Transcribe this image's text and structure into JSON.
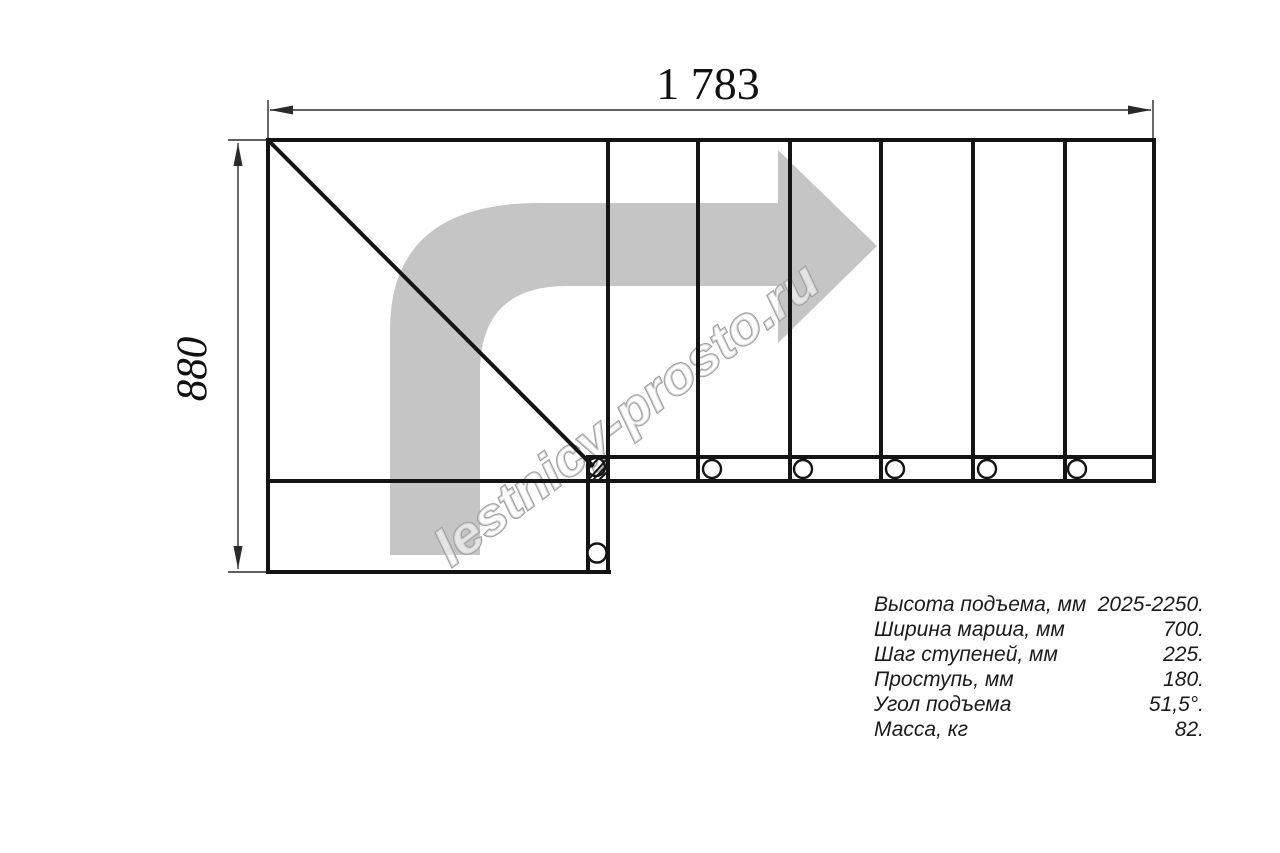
{
  "dimensions": {
    "width_label": "1 783",
    "height_label": "880"
  },
  "watermark": {
    "text": "lestnicy-prosto.ru"
  },
  "specs": {
    "rows": [
      {
        "label": "Высота подъема, мм",
        "value": "2025-2250."
      },
      {
        "label": "Ширина марша, мм",
        "value": "700."
      },
      {
        "label": "Шаг ступеней, мм",
        "value": "225."
      },
      {
        "label": "Проступь, мм",
        "value": "180."
      },
      {
        "label": "Угол подъема",
        "value": "51,5°."
      },
      {
        "label": "Масса, кг",
        "value": "82."
      }
    ]
  },
  "colors": {
    "line": "#141414",
    "dim_line": "#2a2a2a",
    "arrow_fill": "#c5c5c5",
    "watermark_stroke": "#9e9e9e"
  },
  "drawing": {
    "tread_dividers_x": [
      698,
      790,
      881,
      973,
      1065
    ],
    "bolts_x": [
      712,
      803,
      895,
      987,
      1077
    ],
    "bolt_y": 469
  }
}
